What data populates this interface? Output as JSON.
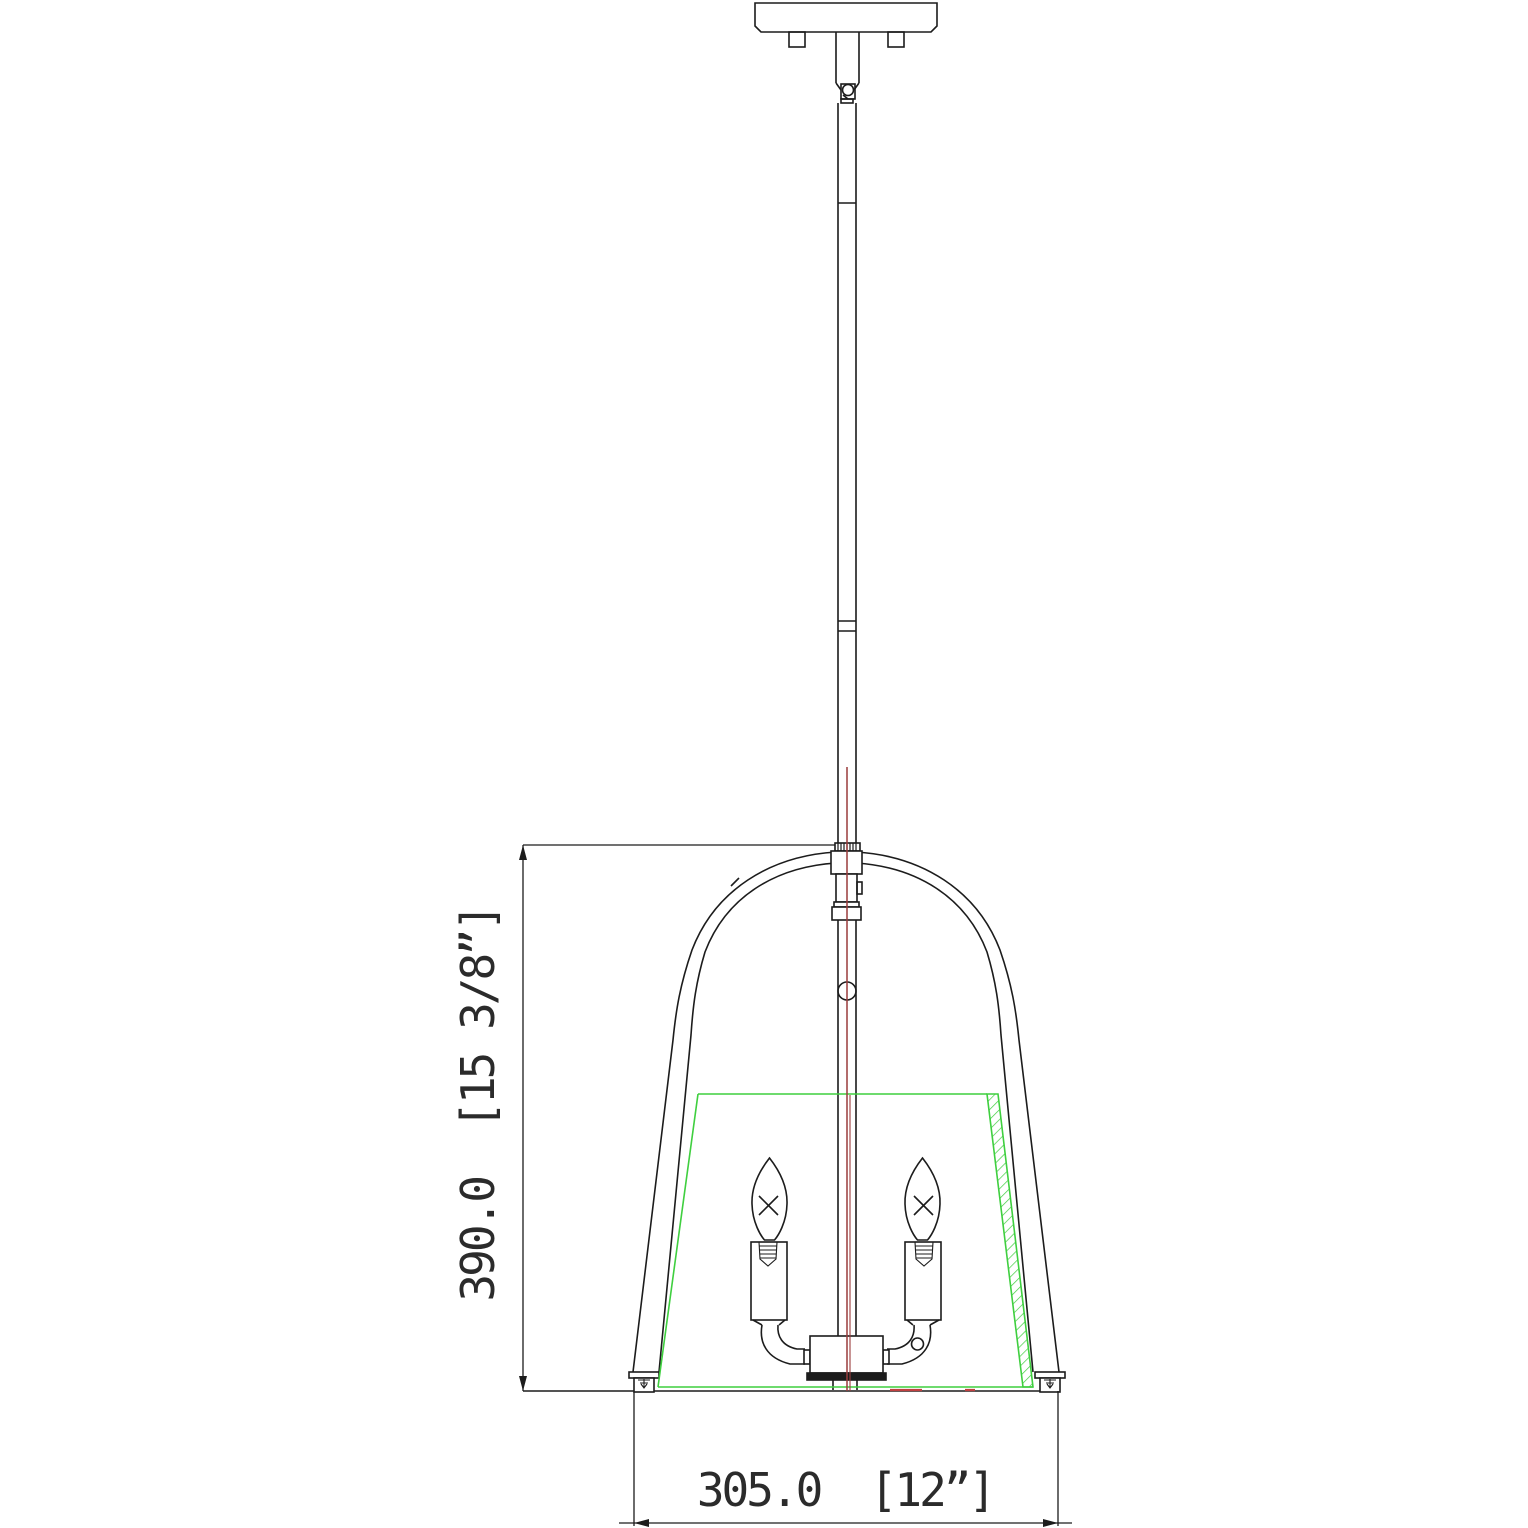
{
  "drawing": {
    "title": "Pendant light fixture dimension drawing",
    "view": "front elevation",
    "dim_height_label": "390.0  [15 3/8”]",
    "dim_width_label": "305.0  [12”]",
    "dim_height_mm": "390.0",
    "dim_height_in": "15 3/8”",
    "dim_width_mm": "305.0",
    "dim_width_in": "12”",
    "colors": {
      "line": "#1c1c1c",
      "shade_outline_green": "#3fcf3f",
      "centerline_red": "#9a3c3c",
      "background": "#ffffff"
    },
    "components": {
      "canopy": "ceiling canopy plate",
      "mount_tabs": "canopy mounting tabs",
      "swivel": "swivel loop joint",
      "downrod": "segmented downrod stem",
      "coupler": "knurled rod coupler",
      "frame": "bell-shaped lantern frame",
      "shade": "tapered drum shade (green outline with hatched section)",
      "bulbs": "2 candelabra bulbs",
      "sockets": "candle sleeve sockets",
      "arms": "curved bulb arms",
      "hub": "central cluster body",
      "feet": "frame foot screws"
    }
  }
}
